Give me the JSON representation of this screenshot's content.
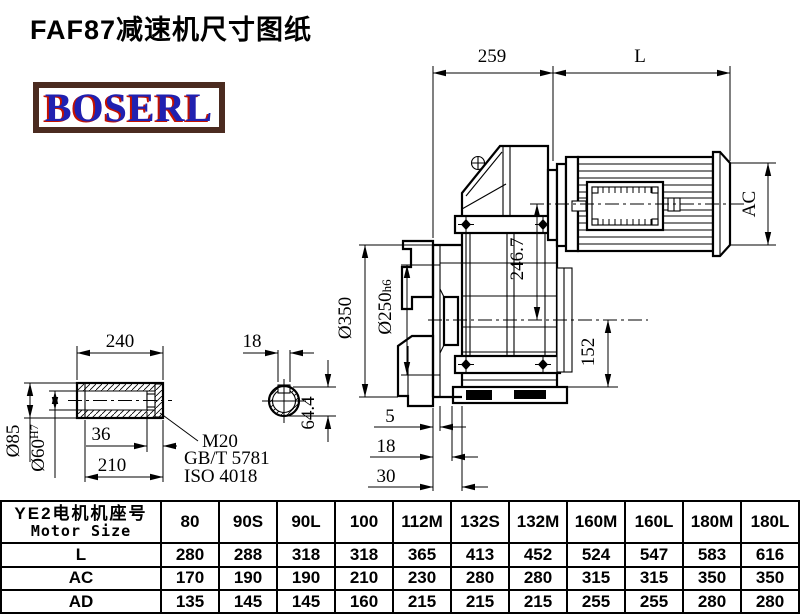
{
  "title": "FAF87减速机尺寸图纸",
  "logo_text": "BOSERL",
  "colors": {
    "logo_border": "#4b2b20",
    "logo_blue": "#2020b0",
    "logo_red_shadow": "#c41200",
    "line": "#000000",
    "background": "#ffffff"
  },
  "drawing": {
    "dim_259": "259",
    "dim_L": "L",
    "dim_AC": "AC",
    "dim_246_7": "246.7",
    "dim_152": "152",
    "dim_350": "Ø350",
    "dim_250": "Ø250",
    "dim_250_tol": "h6",
    "dim_5": "5",
    "dim_18_side": "18",
    "dim_30": "30",
    "shaft": {
      "dim_240": "240",
      "dim_85": "Ø85",
      "dim_60": "Ø60",
      "dim_60_tol": "H7",
      "dim_36": "36",
      "dim_210": "210",
      "thread": "M20",
      "std1": "GB/T 5781",
      "std2": "ISO 4018",
      "dim_18_key": "18",
      "dim_64_4": "64.4"
    }
  },
  "table": {
    "header_cn": "YE2电机机座号",
    "header_en": "Motor Size",
    "columns": [
      "80",
      "90S",
      "90L",
      "100",
      "112M",
      "132S",
      "132M",
      "160M",
      "160L",
      "180M",
      "180L"
    ],
    "rows": [
      {
        "label": "L",
        "values": [
          "280",
          "288",
          "318",
          "318",
          "365",
          "413",
          "452",
          "524",
          "547",
          "583",
          "616"
        ]
      },
      {
        "label": "AC",
        "values": [
          "170",
          "190",
          "190",
          "210",
          "230",
          "280",
          "280",
          "315",
          "315",
          "350",
          "350"
        ]
      },
      {
        "label": "AD",
        "values": [
          "135",
          "145",
          "145",
          "160",
          "215",
          "215",
          "215",
          "255",
          "255",
          "280",
          "280"
        ]
      }
    ]
  }
}
